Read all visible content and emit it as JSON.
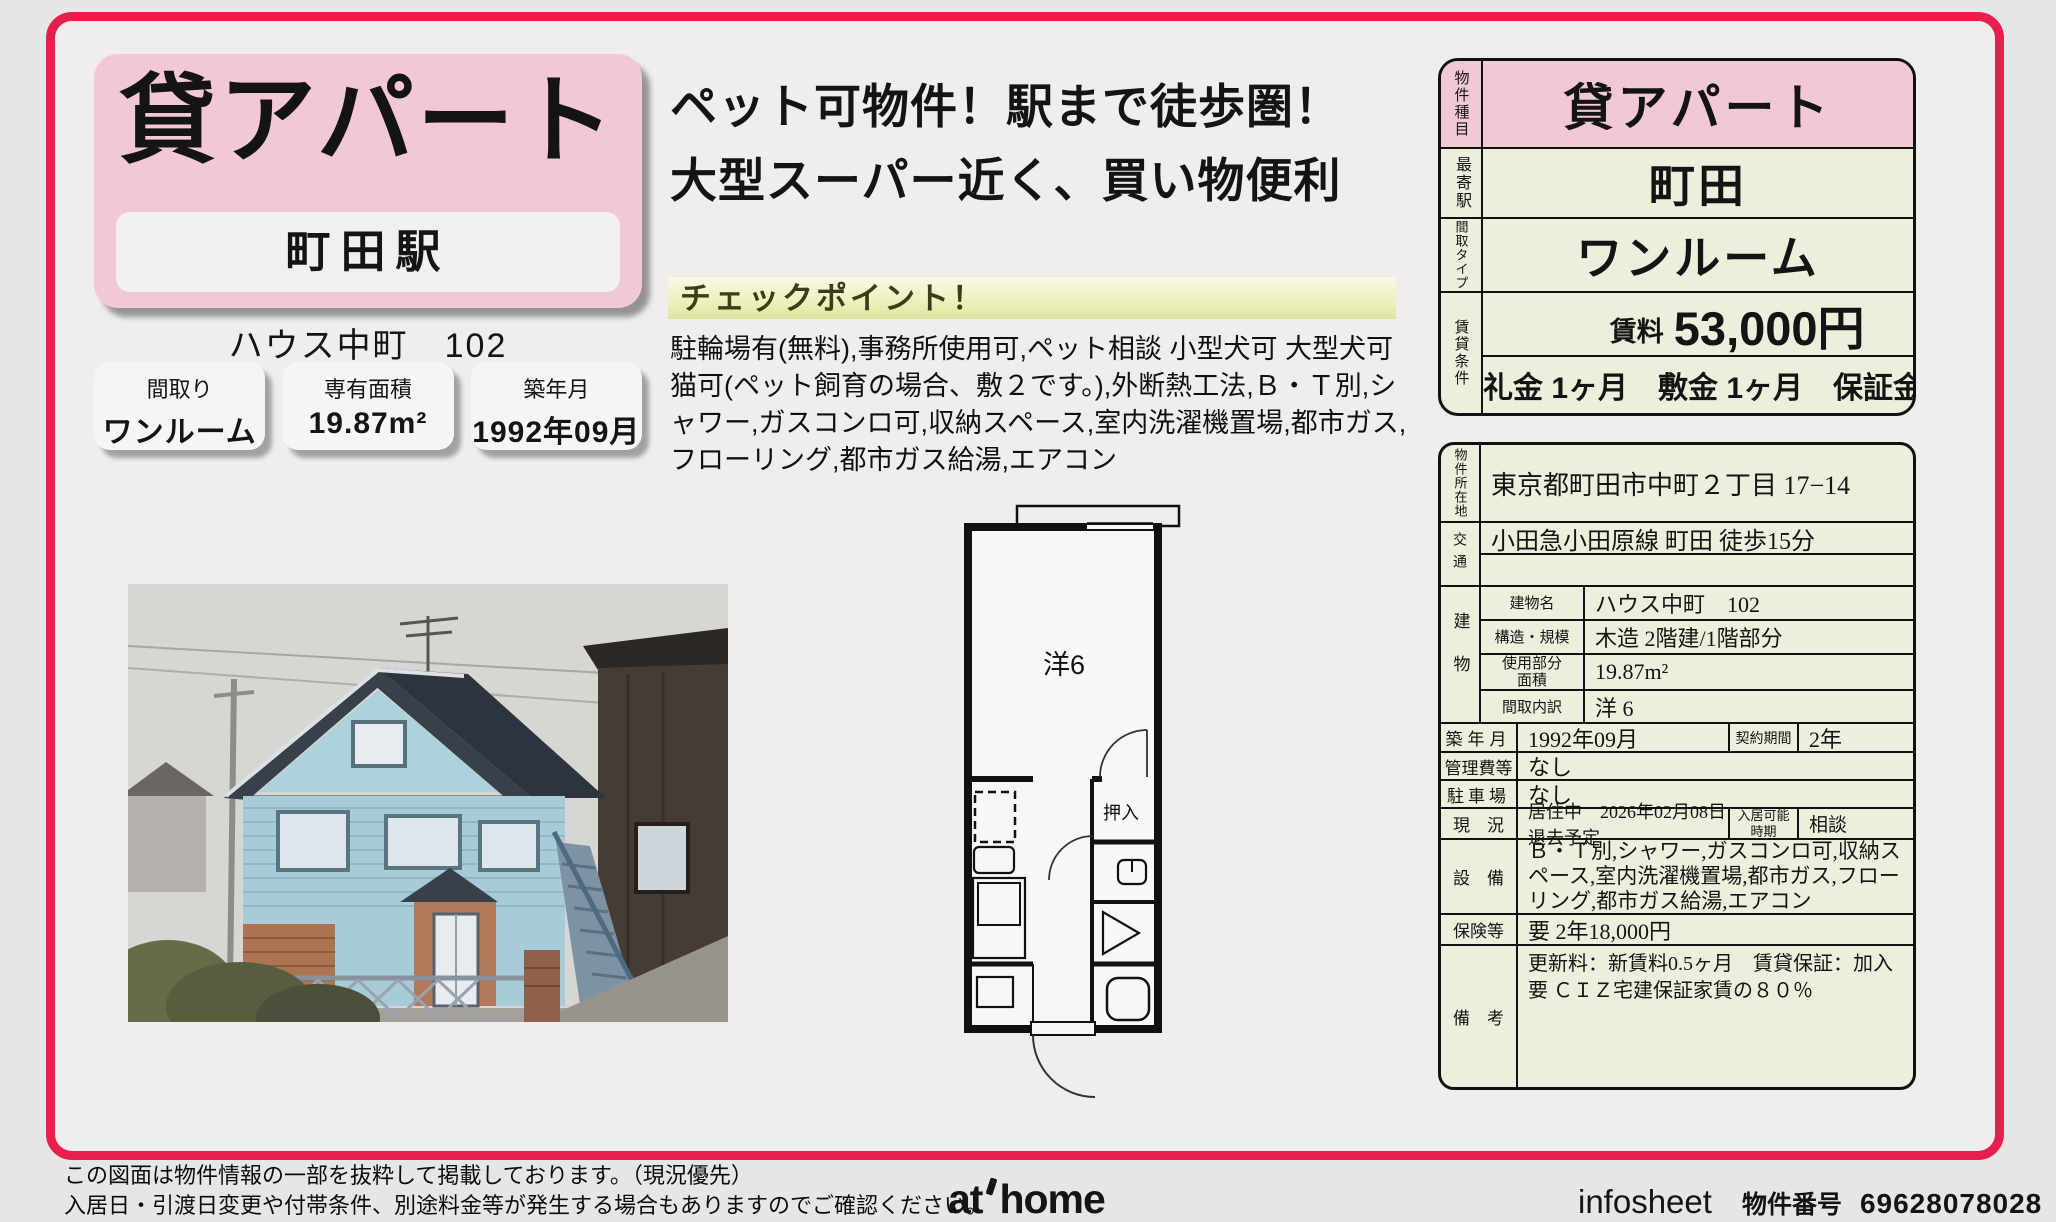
{
  "colors": {
    "frame": "#e81e4f",
    "pink": "#f3c8d5",
    "cream": "#eeeedd",
    "page_bg": "#e6e6e5"
  },
  "header_card": {
    "title": "貸アパート",
    "station": "町田駅",
    "building_name": "ハウス中町　102",
    "stats": [
      {
        "label": "間取り",
        "value": "ワンルーム"
      },
      {
        "label": "専有面積",
        "value": "19.87m²"
      },
      {
        "label": "築年月",
        "value": "1992年09月"
      }
    ]
  },
  "catch": {
    "line1": "ペット可物件！駅まで徒歩圏！",
    "line2": "大型スーパー近く、買い物便利",
    "checkpoint_title": "チェックポイント！",
    "checkpoint_body": "駐輪場有(無料),事務所使用可,ペット相談 小型犬可 大型犬可 猫可(ペット飼育の場合、敷２です。),外断熱工法,Ｂ・Ｔ別,シャワー,ガスコンロ可,収納スペース,室内洗濯機置場,都市ガス,フローリング,都市ガス給湯,エアコン"
  },
  "floorplan": {
    "room_label": "洋6",
    "closet_label": "押入"
  },
  "summary": {
    "rows": [
      {
        "label": "物件種目",
        "value": "貸アパート"
      },
      {
        "label": "最寄駅",
        "value": "町田"
      },
      {
        "label": "間取タイプ",
        "value": "ワンルーム"
      }
    ],
    "rent_row_label": "賃貸条件",
    "rent_label": "賃料",
    "rent_value": "53,000円",
    "terms": "礼金 1ヶ月　敷金 1ヶ月　保証金 なし"
  },
  "detail": {
    "location_label": "物件所在地",
    "location": "東京都町田市中町２丁目 17−14",
    "access_label": "交通",
    "access": "小田急小田原線 町田 徒歩15分",
    "building_label": "建物",
    "building_rows": [
      {
        "label": "建物名",
        "value": "ハウス中町　102"
      },
      {
        "label": "構造・規模",
        "value": "木造 2階建/1階部分"
      },
      {
        "label": "使用部分\n面積",
        "value": "19.87m²"
      },
      {
        "label": "間取内訳",
        "value": "洋 6"
      }
    ],
    "built_label": "築年月",
    "built": "1992年09月",
    "contract_label": "契約期間",
    "contract": "2年",
    "fee_label": "管理費等",
    "fee": "なし",
    "parking_label": "駐車場",
    "parking": "なし",
    "status_label": "現　況",
    "status": "居住中　2026年02月08日退去予定",
    "movein_label": "入居可能\n時期",
    "movein": "相談",
    "equip_label": "設　備",
    "equip": "Ｂ・Ｔ別,シャワー,ガスコンロ可,収納スペース,室内洗濯機置場,都市ガス,フローリング,都市ガス給湯,エアコン",
    "insurance_label": "保険等",
    "insurance": "要 2年18,000円",
    "notes_label": "備　考",
    "notes": "更新料：新賃料0.5ヶ月　賃貸保証：加入要 ＣＩＺ宅建保証家賃の８０％"
  },
  "footer": {
    "disclaimer1": "この図面は物件情報の一部を抜粋して掲載しております。（現況優先）",
    "disclaimer2": "入居日・引渡日変更や付帯条件、別途料金等が発生する場合もありますのでご確認ください。",
    "logo_at": "at",
    "logo_home": "home",
    "infosheet": "infosheet",
    "property_no_label": "物件番号",
    "property_no": "69628078028"
  }
}
